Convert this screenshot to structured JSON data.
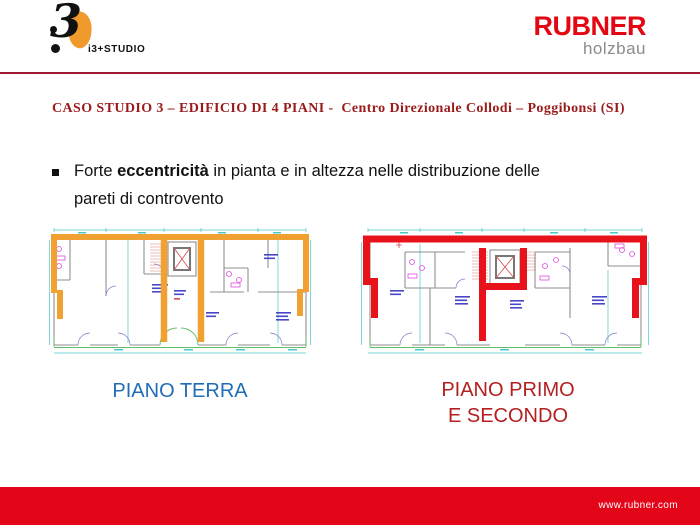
{
  "header": {
    "studio_logo_mark": "3",
    "studio_logo_text": "i3+STUDIO",
    "rubner_brand": "RUBNER",
    "rubner_sub": "holzbau"
  },
  "title": "CASO STUDIO 3 – EDIFICIO DI 4 PIANI -  Centro Direzionale Collodi – Poggibonsi (SI)",
  "bullet": {
    "line1_prefix": "Forte ",
    "line1_bold": "eccentricità",
    "line1_rest": " in pianta e in altezza nelle distribuzione delle",
    "line2": "pareti di controvento"
  },
  "plans": {
    "left": {
      "label": "PIANO TERRA"
    },
    "right": {
      "label_line1": "PIANO PRIMO",
      "label_line2": "E SECONDO"
    }
  },
  "footer": {
    "url_text": "www.rubner.com"
  },
  "colors": {
    "accent_red": "#E30613",
    "logo_gray": "#8C8C8C",
    "logo_orange": "#F0992C",
    "divider_red": "#9E1B32",
    "title_maroon": "#9B1B1B",
    "plan_orange": "#F0A132",
    "plan_red": "#E8121A",
    "footer_red": "#E30619",
    "label_blue": "#1F6DB6",
    "label_red": "#B42020"
  }
}
